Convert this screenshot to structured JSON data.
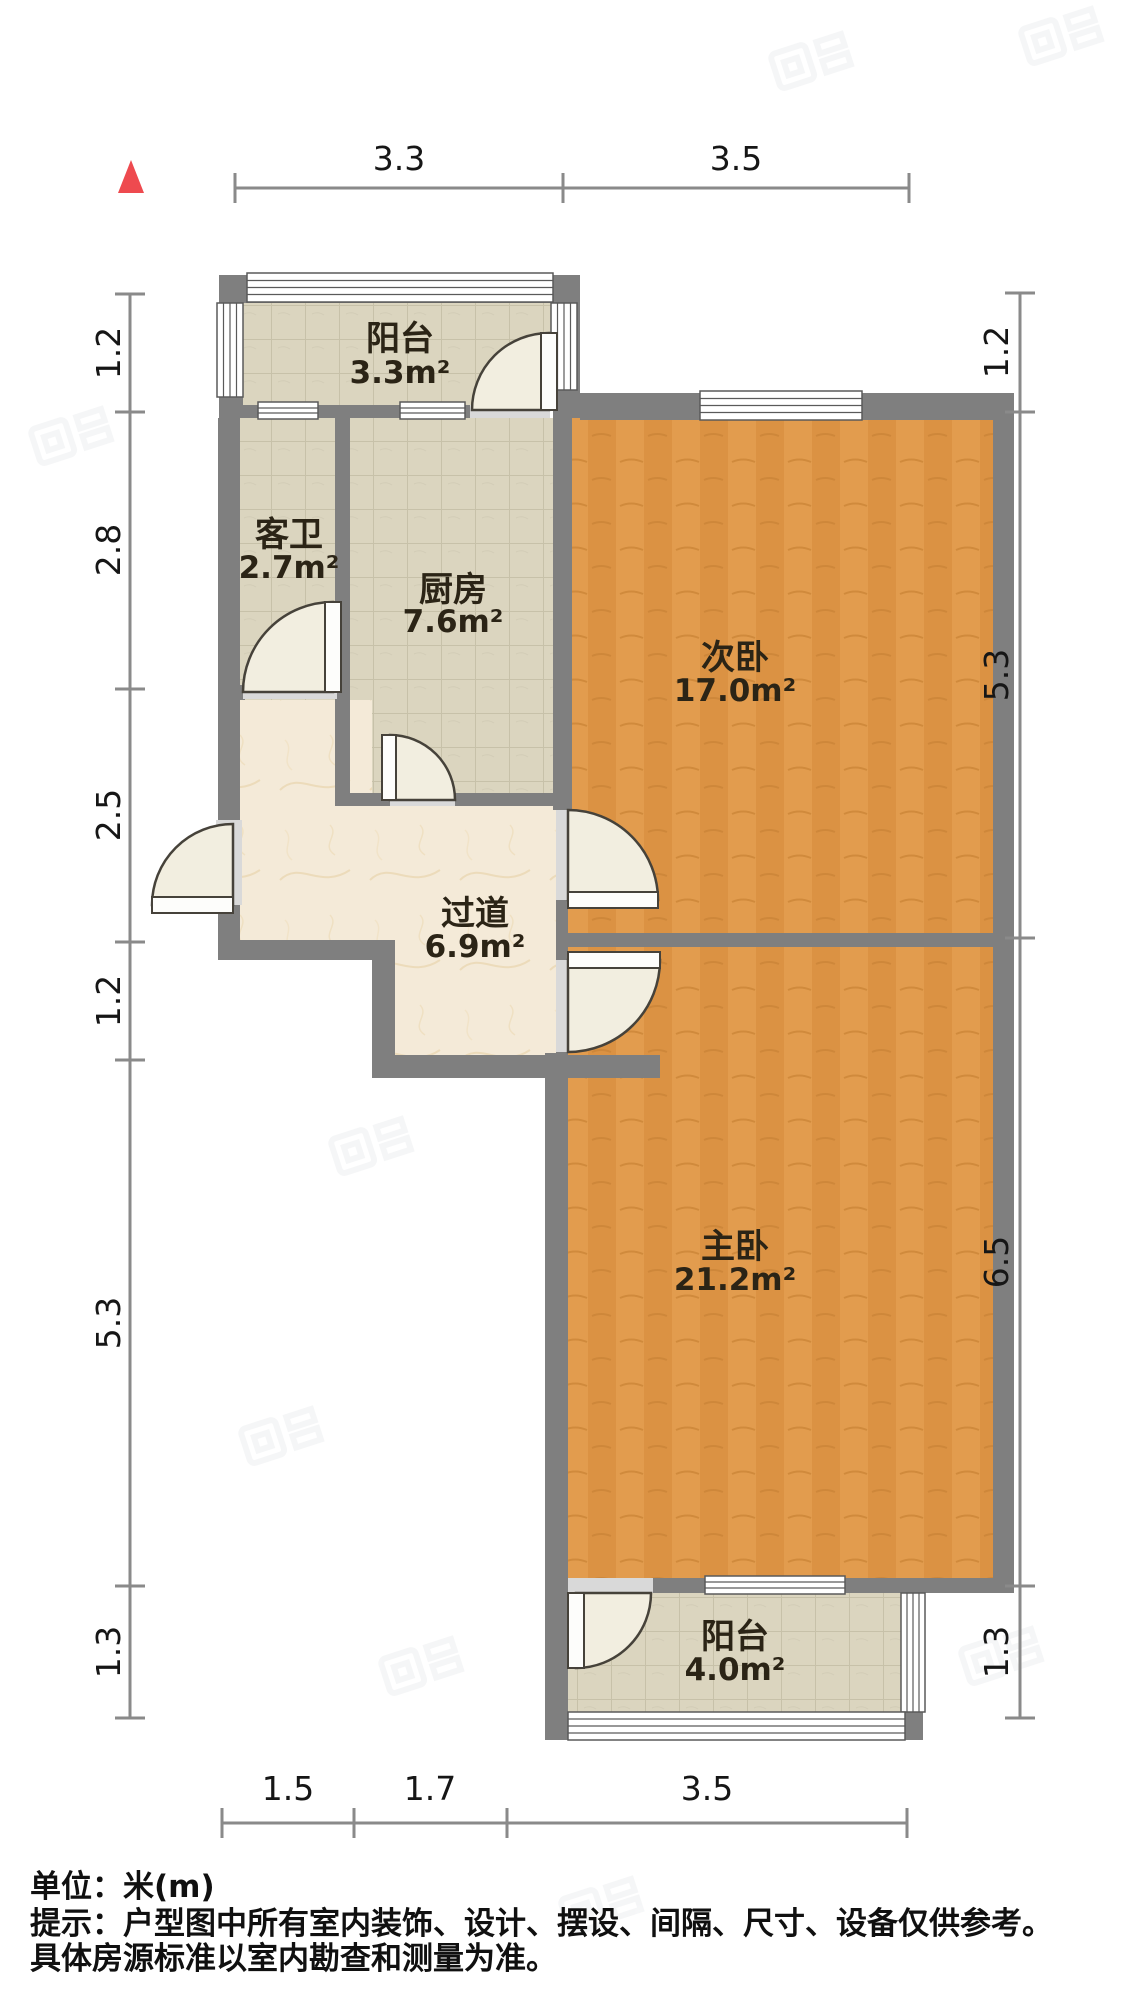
{
  "title": "户型图",
  "units_note": "单位：米(m)",
  "rooms": [
    {
      "name": "阳台",
      "area": "3.3m²"
    },
    {
      "name": "客卫",
      "area": "2.7m²"
    },
    {
      "name": "厨房",
      "area": "7.6m²"
    },
    {
      "name": "次卧",
      "area": "17.0m²"
    },
    {
      "name": "过道",
      "area": "6.9m²"
    },
    {
      "name": "主卧",
      "area": "21.2m²"
    },
    {
      "name": "阳台",
      "area": "4.0m²"
    }
  ],
  "dimensions": {
    "top": [
      "3.3",
      "3.5"
    ],
    "bottom": [
      "1.5",
      "1.7",
      "3.5"
    ],
    "left": [
      "1.2",
      "2.8",
      "2.5",
      "1.2",
      "5.3",
      "1.3"
    ],
    "right": [
      "1.2",
      "5.3",
      "6.5",
      "1.3"
    ]
  },
  "footer": {
    "unit_label": "单位：米(m)",
    "tip_line1": "提示：户型图中所有室内装饰、设计、摆设、间隔、尺寸、设备仅供参考。",
    "tip_line2": "具体房源标准以室内勘查和测量为准。"
  },
  "icons": {
    "north": "red-triangle-up"
  },
  "colors": {
    "wall": "#7f7f7f",
    "wood_floor": "#e29c4e",
    "tile_floor": "#dbd5bf",
    "marble_floor": "#f4ead8",
    "north_arrow": "#ee4a4f",
    "dimension_line": "#8a8a8a"
  }
}
